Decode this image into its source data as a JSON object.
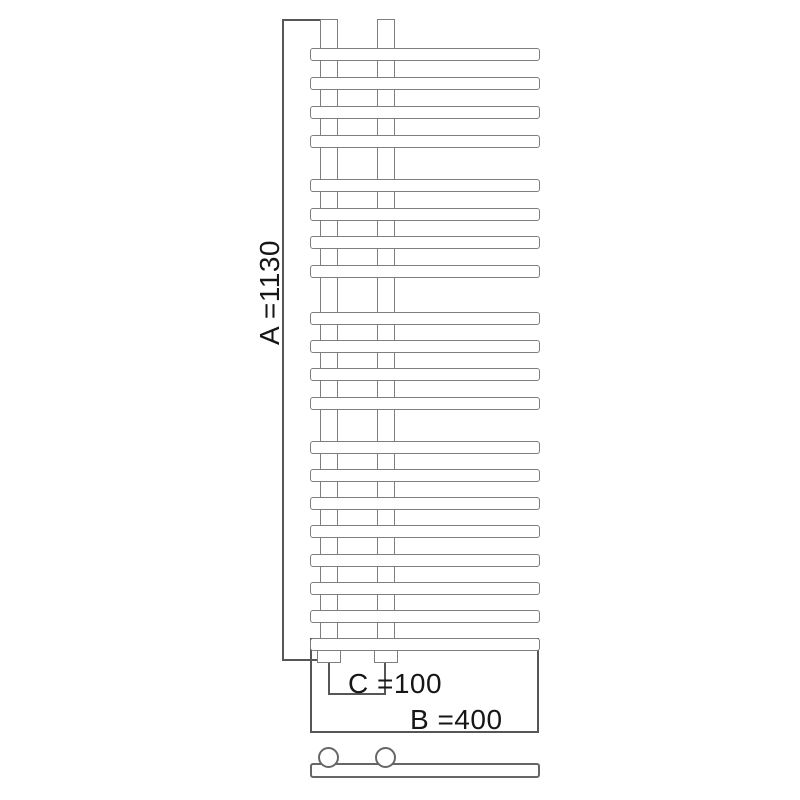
{
  "diagram": {
    "kind": "Technical dimension drawing of a designer bathroom towel radiator, front view",
    "labels": {
      "height": "A =1130",
      "width": "B =400",
      "pipe_spacing": "C =100"
    },
    "dimensions_mm": {
      "A": 1130,
      "B": 400,
      "C": 100
    },
    "structure": {
      "rail_count": 20,
      "rail_groups": [
        4,
        4,
        4,
        8
      ],
      "riser_count": 2,
      "valve_count": 2
    },
    "colors": {
      "radiator_outline": "#7e7e7e",
      "dimension_line": "#565656",
      "text": "#161616",
      "background": "#ffffff"
    }
  }
}
